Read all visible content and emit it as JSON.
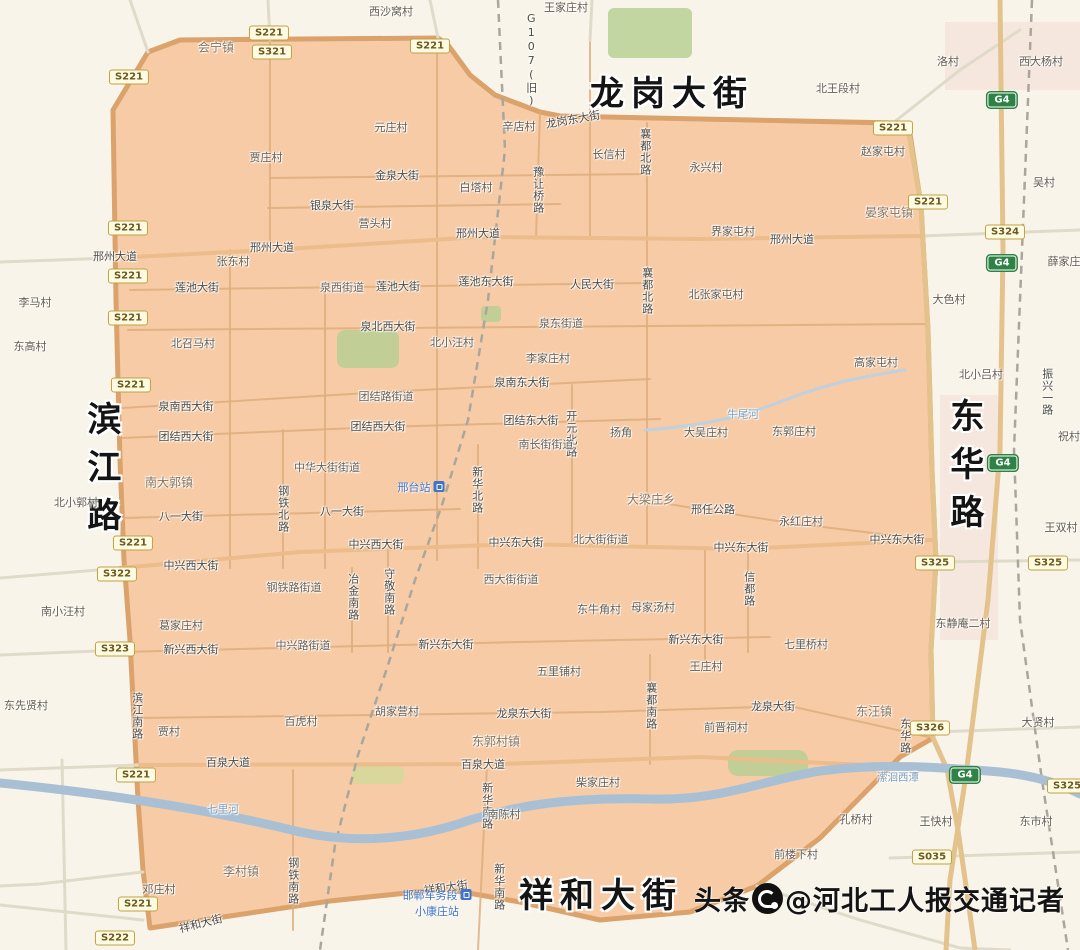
{
  "colors": {
    "outside": "#f8f4ea",
    "zone-fill": "#f6cba6",
    "ring": "#dba26b",
    "road-major": "#ecbc8a",
    "road-minor": "#dfab7b",
    "road-out": "#e0dac8",
    "road-hwy": "#e4c28c",
    "rail": "#aba69c",
    "water": "#a9c0d4",
    "water-light": "#bdd1e0",
    "green": "#b7d093",
    "green-dry": "#d6d89b",
    "pink": "#f2dcd2",
    "lbl-road": "#4e4a42",
    "lbl-village": "#645c4f",
    "lbl-town": "#8a7156",
    "lbl-street": "#6a6156",
    "lbl-water": "#7c9cba",
    "lbl-big": "#141414",
    "lbl-transit": "#3f74c8",
    "shield-s-bg": "#fffbe3",
    "shield-s-border": "#bfa245",
    "shield-s-text": "#6b5a1e",
    "shield-g-bg": "#2f8246"
  },
  "watermark": {
    "platform": "头条",
    "handle": "@河北工人报交通记者"
  },
  "map": {
    "labels": [
      {
        "t": "龙岗大街",
        "x": 672,
        "y": 95,
        "type": "big"
      },
      {
        "t": "滨江路",
        "x": 100,
        "y": 473,
        "type": "big",
        "v": 1
      },
      {
        "t": "东华路",
        "x": 963,
        "y": 470,
        "type": "big",
        "v": 1
      },
      {
        "t": "祥和大街",
        "x": 601,
        "y": 897,
        "type": "big"
      },
      {
        "t": "龙岗东大街",
        "x": 573,
        "y": 120,
        "type": "road",
        "r": -10
      },
      {
        "t": "邢州大道",
        "x": 115,
        "y": 257,
        "type": "road"
      },
      {
        "t": "邢州大道",
        "x": 272,
        "y": 248,
        "type": "road"
      },
      {
        "t": "邢州大道",
        "x": 478,
        "y": 234,
        "type": "road"
      },
      {
        "t": "邢州大道",
        "x": 792,
        "y": 240,
        "type": "road"
      },
      {
        "t": "金泉大街",
        "x": 397,
        "y": 176,
        "type": "road"
      },
      {
        "t": "银泉大街",
        "x": 332,
        "y": 206,
        "type": "road"
      },
      {
        "t": "莲池大街",
        "x": 197,
        "y": 288,
        "type": "road"
      },
      {
        "t": "莲池大街",
        "x": 398,
        "y": 287,
        "type": "road"
      },
      {
        "t": "莲池东大街",
        "x": 486,
        "y": 282,
        "type": "road"
      },
      {
        "t": "人民大街",
        "x": 592,
        "y": 285,
        "type": "road"
      },
      {
        "t": "泉北西大街",
        "x": 388,
        "y": 327,
        "type": "road"
      },
      {
        "t": "泉南西大街",
        "x": 186,
        "y": 407,
        "type": "road"
      },
      {
        "t": "泉南东大街",
        "x": 522,
        "y": 383,
        "type": "road"
      },
      {
        "t": "团结西大街",
        "x": 186,
        "y": 437,
        "type": "road"
      },
      {
        "t": "团结西大街",
        "x": 378,
        "y": 427,
        "type": "road"
      },
      {
        "t": "团结东大街",
        "x": 531,
        "y": 421,
        "type": "road"
      },
      {
        "t": "八一大街",
        "x": 181,
        "y": 517,
        "type": "road"
      },
      {
        "t": "八一大街",
        "x": 342,
        "y": 512,
        "type": "road"
      },
      {
        "t": "中兴西大街",
        "x": 191,
        "y": 566,
        "type": "road"
      },
      {
        "t": "中兴西大街",
        "x": 376,
        "y": 545,
        "type": "road"
      },
      {
        "t": "中兴东大街",
        "x": 516,
        "y": 543,
        "type": "road"
      },
      {
        "t": "中兴东大街",
        "x": 741,
        "y": 548,
        "type": "road"
      },
      {
        "t": "中兴东大街",
        "x": 897,
        "y": 540,
        "type": "road"
      },
      {
        "t": "新兴西大街",
        "x": 191,
        "y": 650,
        "type": "road"
      },
      {
        "t": "新兴东大街",
        "x": 446,
        "y": 645,
        "type": "road"
      },
      {
        "t": "新兴东大街",
        "x": 696,
        "y": 640,
        "type": "road"
      },
      {
        "t": "龙泉东大街",
        "x": 524,
        "y": 714,
        "type": "road"
      },
      {
        "t": "龙泉大街",
        "x": 773,
        "y": 707,
        "type": "road"
      },
      {
        "t": "百泉大道",
        "x": 228,
        "y": 763,
        "type": "road"
      },
      {
        "t": "百泉大道",
        "x": 483,
        "y": 765,
        "type": "road"
      },
      {
        "t": "祥和大街",
        "x": 201,
        "y": 924,
        "type": "road",
        "r": -14
      },
      {
        "t": "祥和大街",
        "x": 446,
        "y": 888,
        "type": "road",
        "r": -8
      },
      {
        "t": "邢任公路",
        "x": 713,
        "y": 510,
        "type": "road"
      },
      {
        "t": "G107(旧)",
        "x": 531,
        "y": 60,
        "type": "road",
        "v": 1
      },
      {
        "t": "豫让桥路",
        "x": 538,
        "y": 190,
        "type": "road",
        "v": 1
      },
      {
        "t": "襄都北路",
        "x": 645,
        "y": 152,
        "type": "road",
        "v": 1
      },
      {
        "t": "襄都北路",
        "x": 647,
        "y": 291,
        "type": "road",
        "v": 1
      },
      {
        "t": "开元北路",
        "x": 571,
        "y": 434,
        "type": "road",
        "v": 1
      },
      {
        "t": "新华北路",
        "x": 477,
        "y": 490,
        "type": "road",
        "v": 1
      },
      {
        "t": "钢铁北路",
        "x": 283,
        "y": 509,
        "type": "road",
        "v": 1
      },
      {
        "t": "信都路",
        "x": 749,
        "y": 589,
        "type": "road",
        "v": 1
      },
      {
        "t": "守敬南路",
        "x": 389,
        "y": 592,
        "type": "road",
        "v": 1
      },
      {
        "t": "冶金南路",
        "x": 353,
        "y": 597,
        "type": "road",
        "v": 1
      },
      {
        "t": "襄都南路",
        "x": 651,
        "y": 706,
        "type": "road",
        "v": 1
      },
      {
        "t": "新华南路",
        "x": 487,
        "y": 806,
        "type": "road",
        "v": 1
      },
      {
        "t": "新华南路",
        "x": 499,
        "y": 887,
        "type": "road",
        "v": 1
      },
      {
        "t": "钢铁南路",
        "x": 293,
        "y": 881,
        "type": "road",
        "v": 1
      },
      {
        "t": "滨江南路",
        "x": 137,
        "y": 716,
        "type": "road",
        "v": 1
      },
      {
        "t": "东华路",
        "x": 905,
        "y": 736,
        "type": "road",
        "v": 1
      },
      {
        "t": "振兴一路",
        "x": 1047,
        "y": 392,
        "type": "road",
        "v": 1
      },
      {
        "t": "泉西街道",
        "x": 342,
        "y": 288,
        "type": "street"
      },
      {
        "t": "泉东街道",
        "x": 561,
        "y": 324,
        "type": "street"
      },
      {
        "t": "团结路街道",
        "x": 386,
        "y": 397,
        "type": "street"
      },
      {
        "t": "南长街街道",
        "x": 546,
        "y": 445,
        "type": "street"
      },
      {
        "t": "中华大街街道",
        "x": 327,
        "y": 468,
        "type": "street"
      },
      {
        "t": "北大街街道",
        "x": 601,
        "y": 540,
        "type": "street"
      },
      {
        "t": "西大街街道",
        "x": 511,
        "y": 580,
        "type": "street"
      },
      {
        "t": "钢铁路街道",
        "x": 294,
        "y": 588,
        "type": "street"
      },
      {
        "t": "中兴路街道",
        "x": 303,
        "y": 646,
        "type": "street"
      },
      {
        "t": "会宁镇",
        "x": 216,
        "y": 48,
        "type": "town"
      },
      {
        "t": "晏家屯镇",
        "x": 889,
        "y": 213,
        "type": "town"
      },
      {
        "t": "南大郭镇",
        "x": 169,
        "y": 483,
        "type": "town"
      },
      {
        "t": "大梁庄乡",
        "x": 651,
        "y": 500,
        "type": "town"
      },
      {
        "t": "东汪镇",
        "x": 874,
        "y": 712,
        "type": "town"
      },
      {
        "t": "东郭村镇",
        "x": 496,
        "y": 742,
        "type": "town"
      },
      {
        "t": "李村镇",
        "x": 241,
        "y": 872,
        "type": "town"
      },
      {
        "t": "西沙窝村",
        "x": 391,
        "y": 12,
        "type": "village"
      },
      {
        "t": "王家庄村",
        "x": 566,
        "y": 8,
        "type": "village"
      },
      {
        "t": "贾庄村",
        "x": 266,
        "y": 158,
        "type": "village"
      },
      {
        "t": "元庄村",
        "x": 391,
        "y": 128,
        "type": "village"
      },
      {
        "t": "辛店村",
        "x": 519,
        "y": 127,
        "type": "village"
      },
      {
        "t": "长信村",
        "x": 609,
        "y": 155,
        "type": "village"
      },
      {
        "t": "永兴村",
        "x": 706,
        "y": 168,
        "type": "village"
      },
      {
        "t": "北王段村",
        "x": 838,
        "y": 89,
        "type": "village"
      },
      {
        "t": "赵家屯村",
        "x": 883,
        "y": 152,
        "type": "village"
      },
      {
        "t": "界家屯村",
        "x": 733,
        "y": 232,
        "type": "village"
      },
      {
        "t": "营头村",
        "x": 375,
        "y": 224,
        "type": "village"
      },
      {
        "t": "白塔村",
        "x": 476,
        "y": 188,
        "type": "village"
      },
      {
        "t": "张东村",
        "x": 233,
        "y": 262,
        "type": "village"
      },
      {
        "t": "李马村",
        "x": 35,
        "y": 303,
        "type": "village"
      },
      {
        "t": "东高村",
        "x": 30,
        "y": 347,
        "type": "village"
      },
      {
        "t": "北召马村",
        "x": 193,
        "y": 344,
        "type": "village"
      },
      {
        "t": "北小汪村",
        "x": 452,
        "y": 343,
        "type": "village"
      },
      {
        "t": "李家庄村",
        "x": 548,
        "y": 359,
        "type": "village"
      },
      {
        "t": "北张家屯村",
        "x": 716,
        "y": 295,
        "type": "village"
      },
      {
        "t": "高家屯村",
        "x": 876,
        "y": 363,
        "type": "village"
      },
      {
        "t": "大色村",
        "x": 949,
        "y": 300,
        "type": "village"
      },
      {
        "t": "洛村",
        "x": 948,
        "y": 62,
        "type": "village"
      },
      {
        "t": "西大杨村",
        "x": 1041,
        "y": 62,
        "type": "village"
      },
      {
        "t": "吴村",
        "x": 1044,
        "y": 183,
        "type": "village"
      },
      {
        "t": "薛家庄",
        "x": 1064,
        "y": 262,
        "type": "village"
      },
      {
        "t": "北小吕村",
        "x": 981,
        "y": 375,
        "type": "village"
      },
      {
        "t": "祝村",
        "x": 1069,
        "y": 437,
        "type": "village"
      },
      {
        "t": "王双村",
        "x": 1061,
        "y": 528,
        "type": "village"
      },
      {
        "t": "北小郭村",
        "x": 76,
        "y": 503,
        "type": "village"
      },
      {
        "t": "南小汪村",
        "x": 63,
        "y": 612,
        "type": "village"
      },
      {
        "t": "扬角",
        "x": 621,
        "y": 433,
        "type": "village"
      },
      {
        "t": "大吴庄村",
        "x": 706,
        "y": 433,
        "type": "village"
      },
      {
        "t": "东郭庄村",
        "x": 794,
        "y": 432,
        "type": "village"
      },
      {
        "t": "永红庄村",
        "x": 801,
        "y": 522,
        "type": "village"
      },
      {
        "t": "母家汤村",
        "x": 653,
        "y": 608,
        "type": "village"
      },
      {
        "t": "东牛角村",
        "x": 599,
        "y": 610,
        "type": "village"
      },
      {
        "t": "葛家庄村",
        "x": 181,
        "y": 626,
        "type": "village"
      },
      {
        "t": "七里桥村",
        "x": 806,
        "y": 645,
        "type": "village"
      },
      {
        "t": "五里铺村",
        "x": 559,
        "y": 672,
        "type": "village"
      },
      {
        "t": "王庄村",
        "x": 706,
        "y": 667,
        "type": "village"
      },
      {
        "t": "东先贤村",
        "x": 26,
        "y": 706,
        "type": "village"
      },
      {
        "t": "贾村",
        "x": 169,
        "y": 732,
        "type": "village"
      },
      {
        "t": "百虎村",
        "x": 301,
        "y": 722,
        "type": "village"
      },
      {
        "t": "胡家营村",
        "x": 397,
        "y": 712,
        "type": "village"
      },
      {
        "t": "前晋祠村",
        "x": 726,
        "y": 728,
        "type": "village"
      },
      {
        "t": "柴家庄村",
        "x": 598,
        "y": 783,
        "type": "village"
      },
      {
        "t": "南陈村",
        "x": 504,
        "y": 815,
        "type": "village"
      },
      {
        "t": "邓庄村",
        "x": 159,
        "y": 890,
        "type": "village"
      },
      {
        "t": "东静庵二村",
        "x": 963,
        "y": 624,
        "type": "village"
      },
      {
        "t": "大贤村",
        "x": 1038,
        "y": 723,
        "type": "village"
      },
      {
        "t": "孔桥村",
        "x": 856,
        "y": 820,
        "type": "village"
      },
      {
        "t": "王快村",
        "x": 936,
        "y": 822,
        "type": "village"
      },
      {
        "t": "东市村",
        "x": 1036,
        "y": 822,
        "type": "village"
      },
      {
        "t": "前楼下村",
        "x": 796,
        "y": 855,
        "type": "village"
      },
      {
        "t": "七里河",
        "x": 223,
        "y": 810,
        "type": "water-lbl"
      },
      {
        "t": "牛尾河",
        "x": 743,
        "y": 415,
        "type": "water-lbl"
      },
      {
        "t": "潆洄西潭",
        "x": 898,
        "y": 778,
        "type": "water-lbl"
      }
    ],
    "badges": [
      {
        "code": "S221",
        "x": 129,
        "y": 77,
        "kind": "s"
      },
      {
        "code": "S221",
        "x": 269,
        "y": 33,
        "kind": "s"
      },
      {
        "code": "S321",
        "x": 272,
        "y": 52,
        "kind": "s"
      },
      {
        "code": "S221",
        "x": 430,
        "y": 46,
        "kind": "s"
      },
      {
        "code": "S221",
        "x": 893,
        "y": 128,
        "kind": "s"
      },
      {
        "code": "S221",
        "x": 928,
        "y": 202,
        "kind": "s"
      },
      {
        "code": "S221",
        "x": 128,
        "y": 228,
        "kind": "s"
      },
      {
        "code": "S221",
        "x": 128,
        "y": 276,
        "kind": "s"
      },
      {
        "code": "S221",
        "x": 128,
        "y": 318,
        "kind": "s"
      },
      {
        "code": "S221",
        "x": 131,
        "y": 385,
        "kind": "s"
      },
      {
        "code": "S221",
        "x": 133,
        "y": 543,
        "kind": "s"
      },
      {
        "code": "S322",
        "x": 117,
        "y": 574,
        "kind": "s"
      },
      {
        "code": "S323",
        "x": 115,
        "y": 649,
        "kind": "s"
      },
      {
        "code": "S221",
        "x": 136,
        "y": 775,
        "kind": "s"
      },
      {
        "code": "S221",
        "x": 138,
        "y": 904,
        "kind": "s"
      },
      {
        "code": "S222",
        "x": 115,
        "y": 938,
        "kind": "s"
      },
      {
        "code": "S324",
        "x": 1005,
        "y": 232,
        "kind": "s"
      },
      {
        "code": "S325",
        "x": 935,
        "y": 563,
        "kind": "s"
      },
      {
        "code": "S325",
        "x": 1048,
        "y": 563,
        "kind": "s"
      },
      {
        "code": "S326",
        "x": 930,
        "y": 728,
        "kind": "s"
      },
      {
        "code": "S035",
        "x": 932,
        "y": 857,
        "kind": "s"
      },
      {
        "code": "S325",
        "x": 1067,
        "y": 786,
        "kind": "s"
      },
      {
        "code": "G4",
        "x": 1002,
        "y": 100,
        "kind": "g"
      },
      {
        "code": "G4",
        "x": 1002,
        "y": 263,
        "kind": "g"
      },
      {
        "code": "G4",
        "x": 1003,
        "y": 463,
        "kind": "g"
      },
      {
        "code": "G4",
        "x": 965,
        "y": 775,
        "kind": "g"
      }
    ],
    "transit": [
      {
        "t": "邢台站",
        "x": 421,
        "y": 487
      },
      {
        "t": "邯郸车务段",
        "t2": "小康庄站",
        "x": 437,
        "y": 903
      }
    ]
  }
}
